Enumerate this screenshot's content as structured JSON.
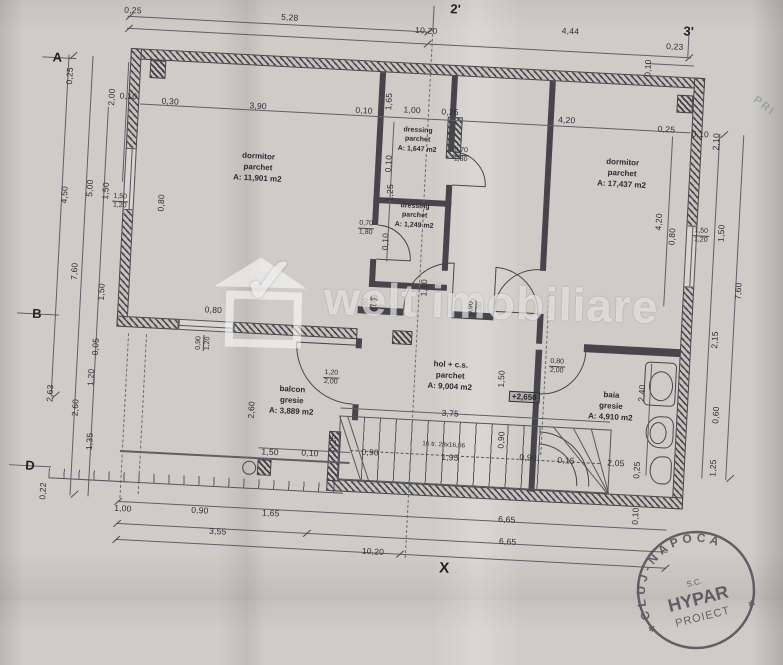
{
  "plan": {
    "rooms": [
      {
        "name": "dormitor",
        "finish": "parchet",
        "area": "A: 11,901 m2"
      },
      {
        "name": "dressing",
        "finish": "parchet",
        "area": "A: 1,647 m2"
      },
      {
        "name": "dressing",
        "finish": "parchet",
        "area": "A: 1,249 m2"
      },
      {
        "name": "dormitor",
        "finish": "parchet",
        "area": "A: 17,437 m2"
      },
      {
        "name": "hol + c.s.",
        "finish": "parchet",
        "area": "A: 9,004 m2"
      },
      {
        "name": "balcon",
        "finish": "gresie",
        "area": "A: 3,889 m2"
      },
      {
        "name": "baia",
        "finish": "gresie",
        "area": "A: 4,910 m2"
      }
    ],
    "stairs_label": "16 tr. 28x16,56",
    "level_marker": "+2,650",
    "axes": {
      "row_a": "A",
      "row_b": "B",
      "row_d": "D",
      "col_2": "2'",
      "col_3": "3'",
      "bottom_x": "X"
    },
    "dims": [
      "0,25",
      "5,28",
      "10,20",
      "4,44",
      "0,23",
      "0,25",
      "2,00",
      "0,10",
      "0,30",
      "3,90",
      "0,10",
      "1,65",
      "1,00",
      "0,25",
      "4,20",
      "0,25",
      "0,10",
      "0,10",
      "2,10",
      "4,50",
      "5,00",
      "1,50",
      "1,50",
      "1,20",
      "0,80",
      "7,60",
      "1,50",
      "0,05",
      "1,20",
      "2,63",
      "2,60",
      "1,35",
      "0,22",
      "0,80",
      "1,50",
      "1,20",
      "1,50",
      "7,60",
      "4,20",
      "2,15",
      "0,60",
      "1,25",
      "2,40",
      "0,70",
      "1,80",
      "0,10",
      "1,25",
      "0,70",
      "1,80",
      "0,10",
      "1,10",
      "0,90",
      "2,00",
      "0,90",
      "2,00",
      "0,80",
      "0,90",
      "1,20",
      "1,20",
      "2,00",
      "2,60",
      "1,50",
      "0,80",
      "2,00",
      "3,75",
      "0,90",
      "1,95",
      "0,90",
      "0,90",
      "0,15",
      "2,05",
      "0,25",
      "1,50",
      "0,10",
      "0,25",
      "1,00",
      "0,90",
      "1,65",
      "3,55",
      "10,20",
      "6,65",
      "6,65",
      "0,10"
    ]
  },
  "watermark": {
    "brand": "welt imobiliare",
    "check": "✓"
  },
  "stamp": {
    "arc": "CLUJ-NAPOCA",
    "line1": "S.C.",
    "line2": "HYPAR",
    "line3": "PROIECT",
    "star": "✱"
  },
  "corner_note": "PRI"
}
